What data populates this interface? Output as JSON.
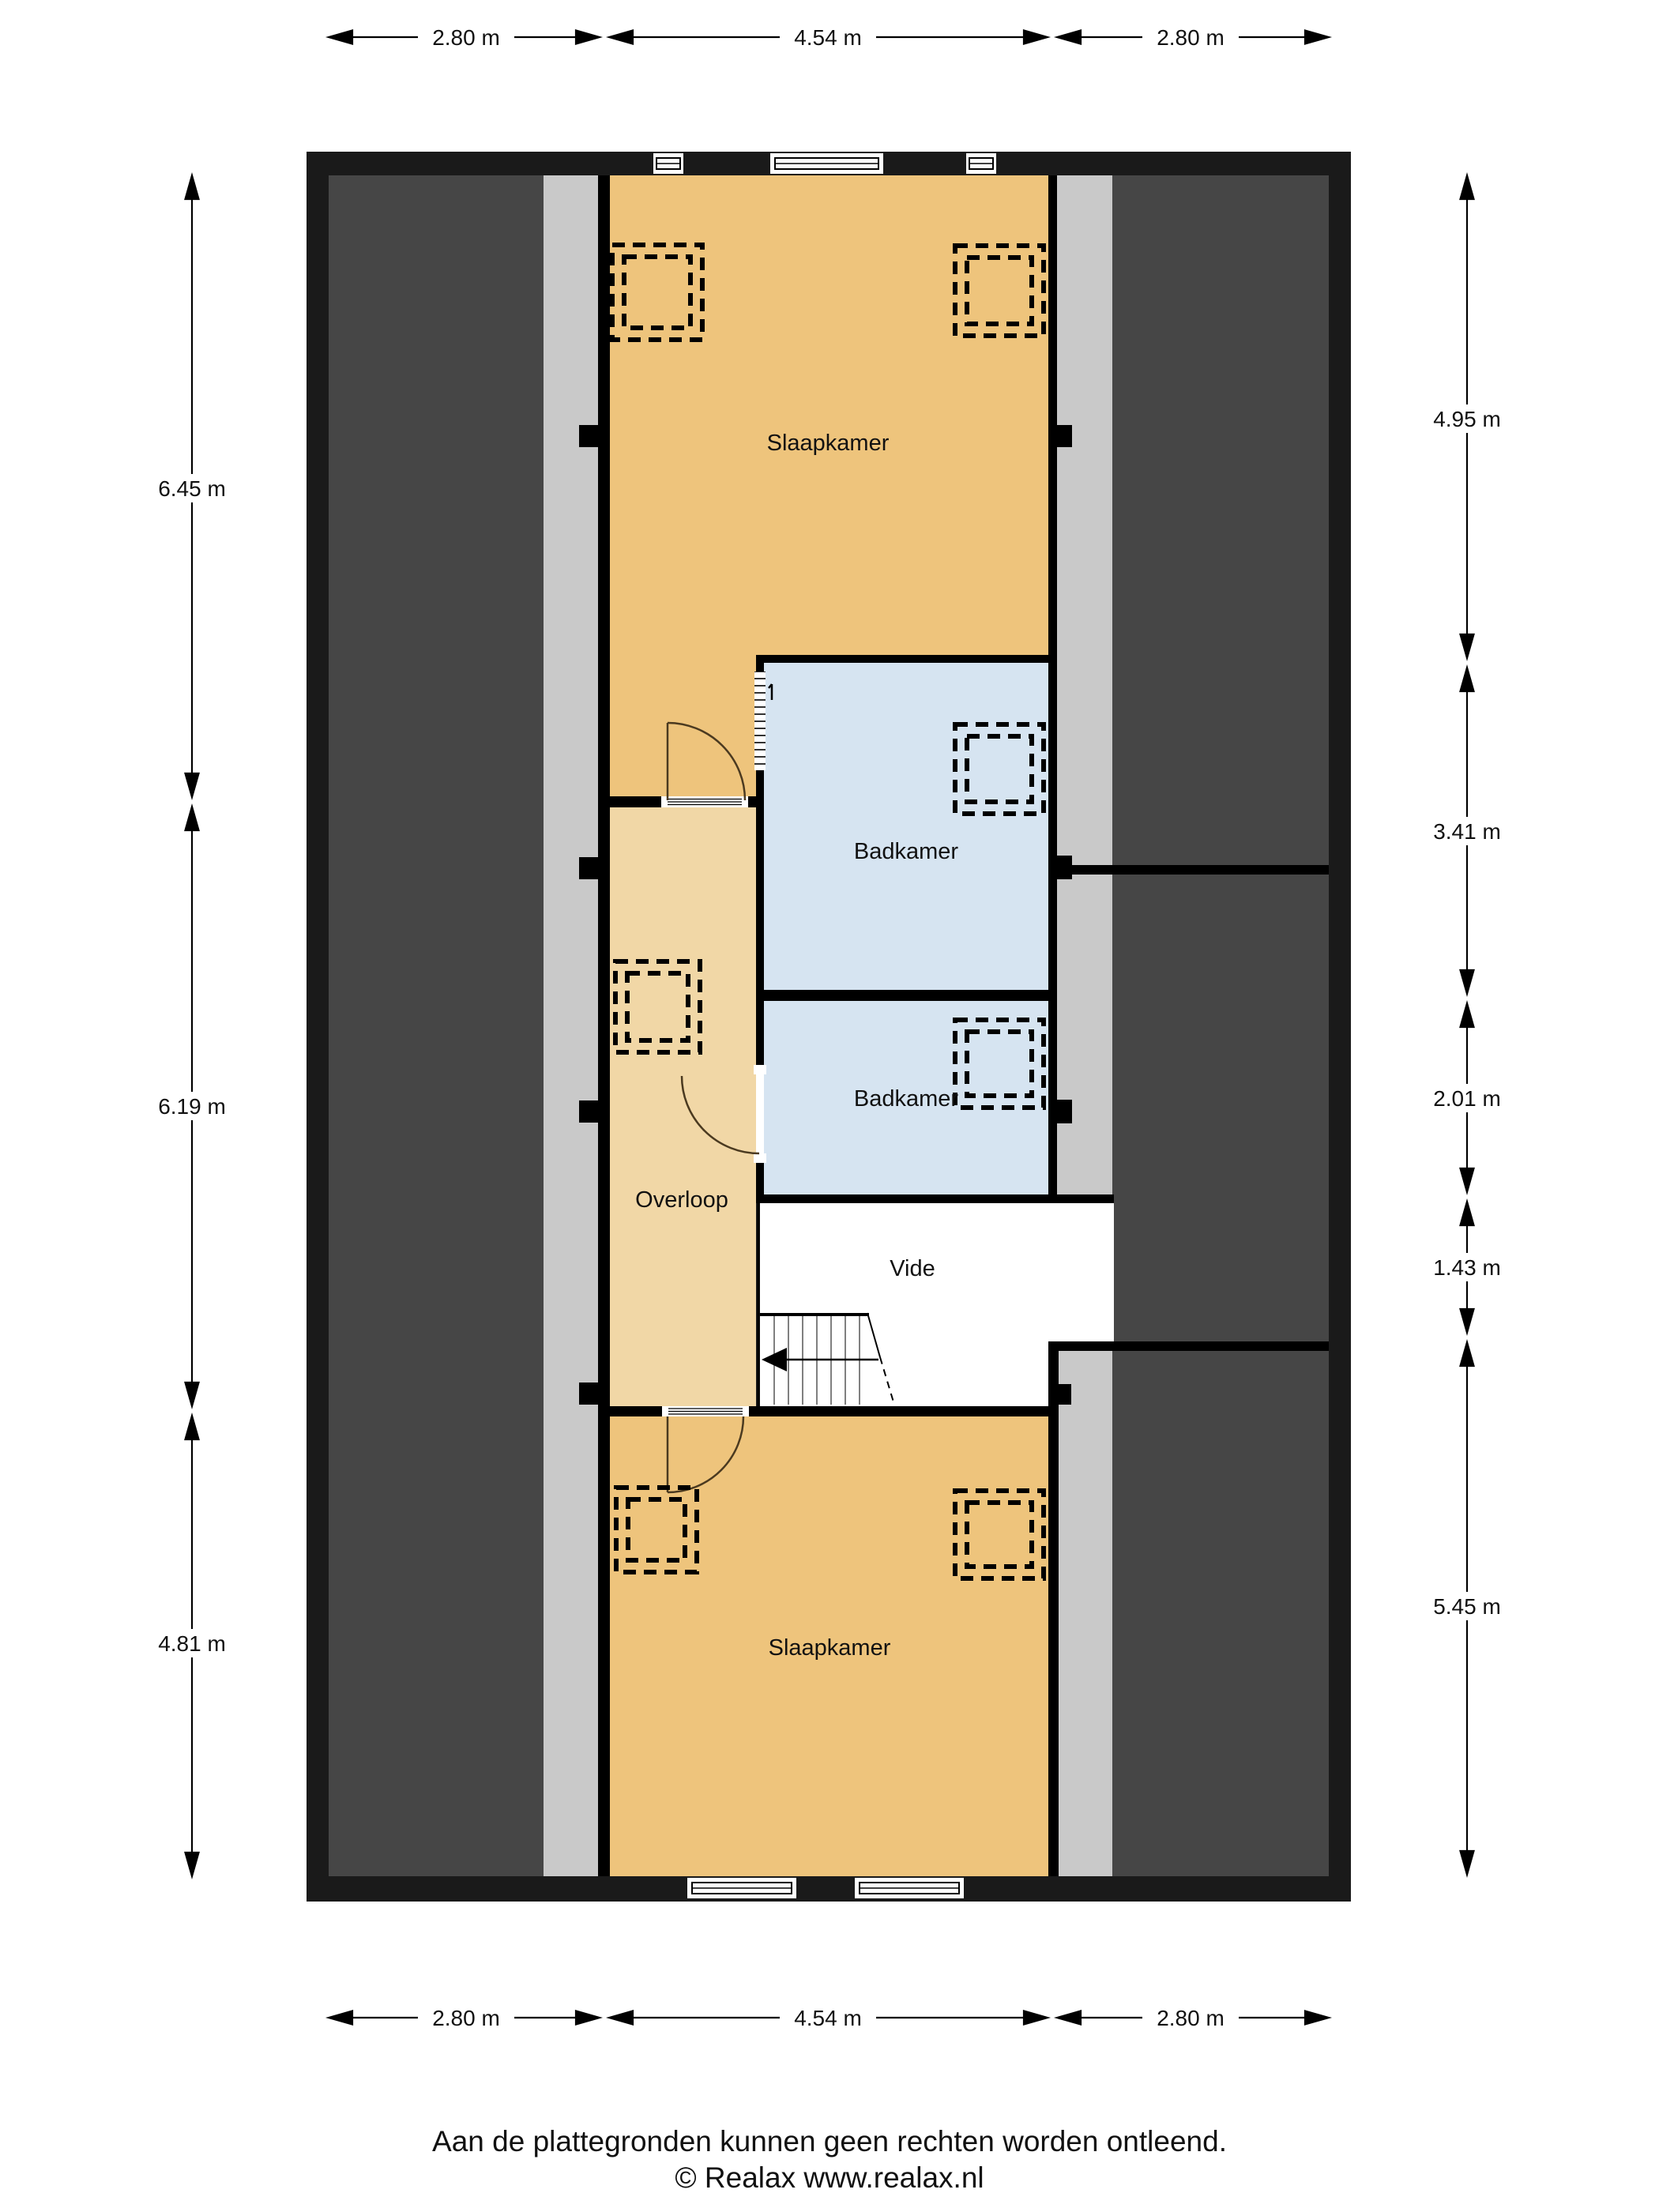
{
  "rooms": {
    "bedroom_top": "Slaapkamer",
    "bathroom_top": "Badkamer",
    "bathroom_bottom": "Badkamer",
    "landing": "Overloop",
    "void": "Vide",
    "bedroom_bottom": "Slaapkamer"
  },
  "dims": {
    "top": [
      {
        "label": "2.80 m"
      },
      {
        "label": "4.54 m"
      },
      {
        "label": "2.80 m"
      }
    ],
    "bottom": [
      {
        "label": "2.80 m"
      },
      {
        "label": "4.54 m"
      },
      {
        "label": "2.80 m"
      }
    ],
    "left": [
      {
        "label": "6.45 m"
      },
      {
        "label": "6.19 m"
      },
      {
        "label": "4.81 m"
      }
    ],
    "right": [
      {
        "label": "4.95 m"
      },
      {
        "label": "3.41 m"
      },
      {
        "label": "2.01 m"
      },
      {
        "label": "1.43 m"
      },
      {
        "label": "5.45 m"
      }
    ]
  },
  "footer": {
    "disclaimer": "Aan de plattegronden kunnen geen rechten worden ontleend.",
    "copyright": "© Realax www.realax.nl"
  },
  "colors": {
    "wall": "#000000",
    "outer_wall": "#1a1a1a",
    "roof_space": "#464646",
    "eaves_strip": "#c9c9c9",
    "bedroom": "#eec47c",
    "landing": "#f1d7a6",
    "bathroom": "#d6e4f1",
    "void_area": "#ffffff",
    "door_arc": "#4b3a20"
  }
}
